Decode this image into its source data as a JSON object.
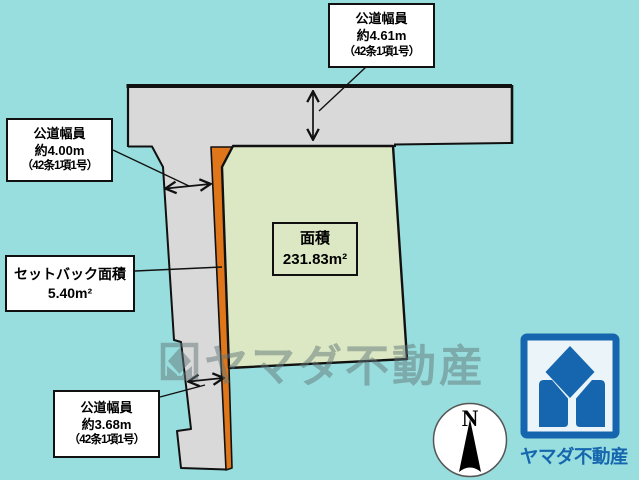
{
  "boxes": {
    "road_top": {
      "lines": [
        "公道幅員",
        "約4.61m",
        "（42条1項1号）"
      ]
    },
    "road_left": {
      "lines": [
        "公道幅員",
        "約4.00m",
        "（42条1項1号）"
      ]
    },
    "setback": {
      "lines": [
        "セットバック面積",
        "5.40m²"
      ]
    },
    "road_bottom": {
      "lines": [
        "公道幅員",
        "約3.68m",
        "（42条1項1号）"
      ]
    }
  },
  "plot": {
    "area_title": "面積",
    "area_value": "231.83m²"
  },
  "watermark": {
    "text": "ヤマダ不動産"
  },
  "compass": {
    "north_label": "N"
  },
  "brand": {
    "company_name": "ヤマダ不動産"
  },
  "icons": [
    "north-compass-icon",
    "yamada-logo-icon",
    "watermark-logo-icon"
  ],
  "colors": {
    "bg": "#98dede",
    "road": "#d9d9d9",
    "line": "#111111",
    "plot": "#dce8c3",
    "setback": "#e0761a",
    "watermark": "#64787a",
    "logo_blue": "#1566ae",
    "logo_bg": "#eaf4f9",
    "white": "#ffffff"
  }
}
